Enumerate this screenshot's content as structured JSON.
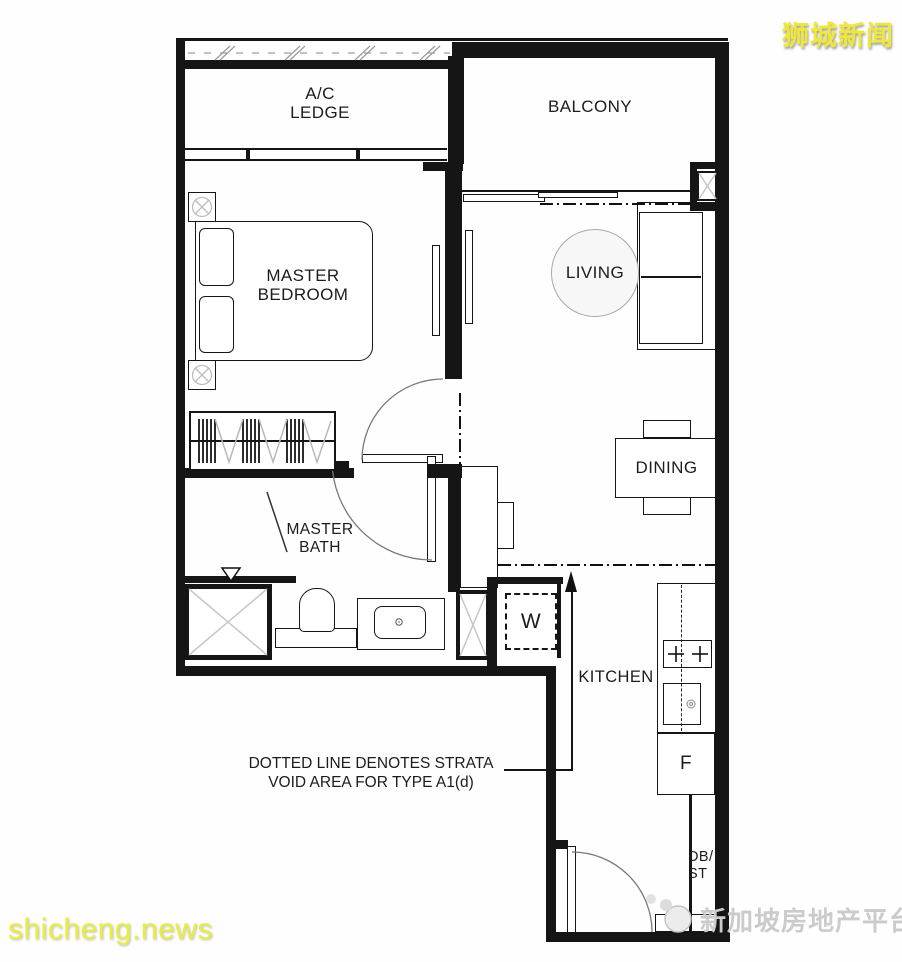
{
  "watermarks": {
    "top_right": "狮城新闻",
    "bottom_left": "shicheng.news",
    "bottom_right": "新加坡房地产平台"
  },
  "annotation": {
    "line1": "DOTTED LINE DENOTES STRATA",
    "line2": "VOID AREA FOR TYPE A1(d)"
  },
  "rooms": {
    "ac_ledge": {
      "line1": "A/C",
      "line2": "LEDGE"
    },
    "balcony": "BALCONY",
    "master_bedroom": {
      "line1": "MASTER",
      "line2": "BEDROOM"
    },
    "living": "LIVING",
    "dining": "DINING",
    "master_bath": {
      "line1": "MASTER",
      "line2": "BATH"
    },
    "kitchen": "KITCHEN"
  },
  "fixtures": {
    "washer": "W",
    "fridge": "F",
    "db_store": {
      "line1": "DB/",
      "line2": "ST"
    }
  },
  "colors": {
    "line": "#151515",
    "symbol_gray": "#c6c6c6",
    "watermark_yellow": "#eeea3c",
    "watermark_gray": "#c8c8c8"
  }
}
